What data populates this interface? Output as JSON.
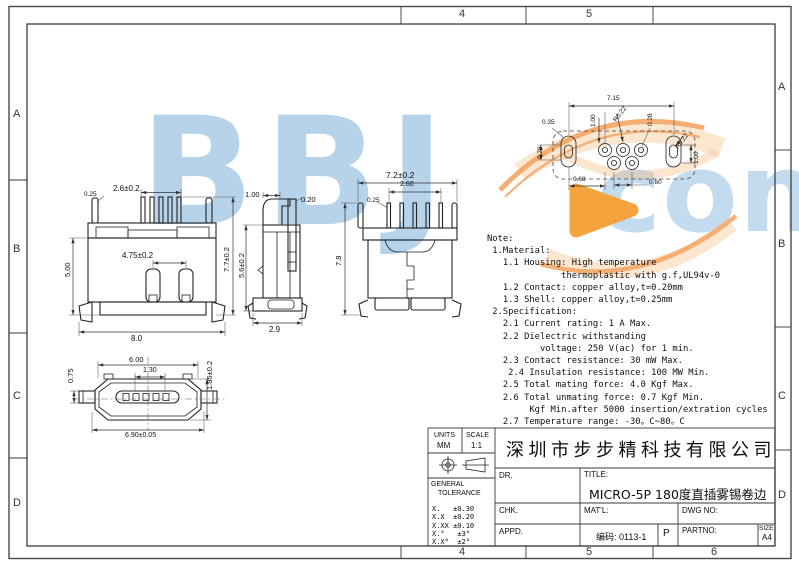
{
  "page": {
    "background": "#ffffff",
    "line_color": "#222222",
    "watermark_blue": "#b6d3ea",
    "watermark_orange": "#f5a33c"
  },
  "border": {
    "top": [
      "4",
      "5"
    ],
    "bottom": [
      "4",
      "5",
      "6"
    ],
    "left": [
      "A",
      "B",
      "C",
      "D"
    ],
    "right": [
      "A",
      "B",
      "C",
      "D"
    ]
  },
  "watermark": {
    "main": "BBJ",
    "sub": "conn"
  },
  "views": {
    "front": {
      "dims": {
        "pin_width": "0.25",
        "pin_span": "2.6±0.2",
        "body_height": "5.00",
        "post_span": "4.75±0.2",
        "overall_height": "7.7±0.2",
        "overall_width": "8.0"
      }
    },
    "side": {
      "dims": {
        "top_width": "1.00",
        "pin_thickness": "0.20",
        "body_height": "5.6±0.2",
        "depth": "2.9"
      }
    },
    "rear": {
      "dims": {
        "overall_width": "7.2±0.2",
        "pin_span": "2.60",
        "pin_width": "0.25",
        "overall_height": "7.8"
      }
    },
    "bottom": {
      "dims": {
        "shell_width": "6.00",
        "latch_height": "0.75",
        "tongue_inset": "1.30",
        "shell_height": "1.85±0.2",
        "overall_width": "6.90±0.05"
      }
    },
    "footprint": {
      "dims": {
        "pad_span": "7.15",
        "edge_offset": "0.35",
        "pad_length": "0.78",
        "pad_pitch_left": "1.00",
        "pad_radius_left": "R0.22",
        "hole_width": "0.28",
        "pad_radius_right": "R0.22",
        "pad_pitch_right": "1.00",
        "row_offset": "0.68",
        "pad_pitch": "0.60"
      }
    }
  },
  "notes": {
    "lines": [
      "Note:",
      " 1.Material:",
      "   1.1 Housing: High temperature",
      "              thermoplastic with g.f,UL94v-0",
      "   1.2 Contact: copper alloy,t=0.20mm",
      "   1.3 Shell: copper alloy,t=0.25mm",
      " 2.Specification:",
      "   2.1 Current rating: 1 A Max.",
      "   2.2 Dielectric withstanding",
      "          voltage: 250 V(ac) for 1 min.",
      "   2.3 Contact resistance: 30 mW Max.",
      "    2.4 Insulation resistance: 100 MW Min.",
      "   2.5 Total mating force: 4.0 Kgf Max.",
      "   2.6 Total unmating force: 0.7 Kgf Min.",
      "        Kgf Min.after 5000 insertion/extration cycles",
      "   2.7 Temperature range: -30。C~80。C"
    ]
  },
  "title_block": {
    "units_label": "UNITS",
    "units_value": "MM",
    "scale_label": "SCALE",
    "scale_value": "1:1",
    "company": "深圳市步步精科技有限公司",
    "general_line1": "GENERAL",
    "general_line2": "TOLERANCE",
    "tolerances": [
      "X.   ±0.30",
      "X.X  ±0.20",
      "X.XX ±0.10",
      "X.°   ±3°",
      "X.X°  ±2°"
    ],
    "dr_label": "DR.",
    "title_label": "TITLE:",
    "title_value": "MICRO-5P 180度直插雾锡卷边",
    "chk_label": "CHK.",
    "matl_label": "MAT'L:",
    "dwg_label": "DWG NO:",
    "appd_label": "APPD.",
    "code_value": "编码: 0113-1",
    "p_value": "P",
    "partno_label": "PARTNO:",
    "size_label": "SIZE",
    "size_value": "A4"
  }
}
